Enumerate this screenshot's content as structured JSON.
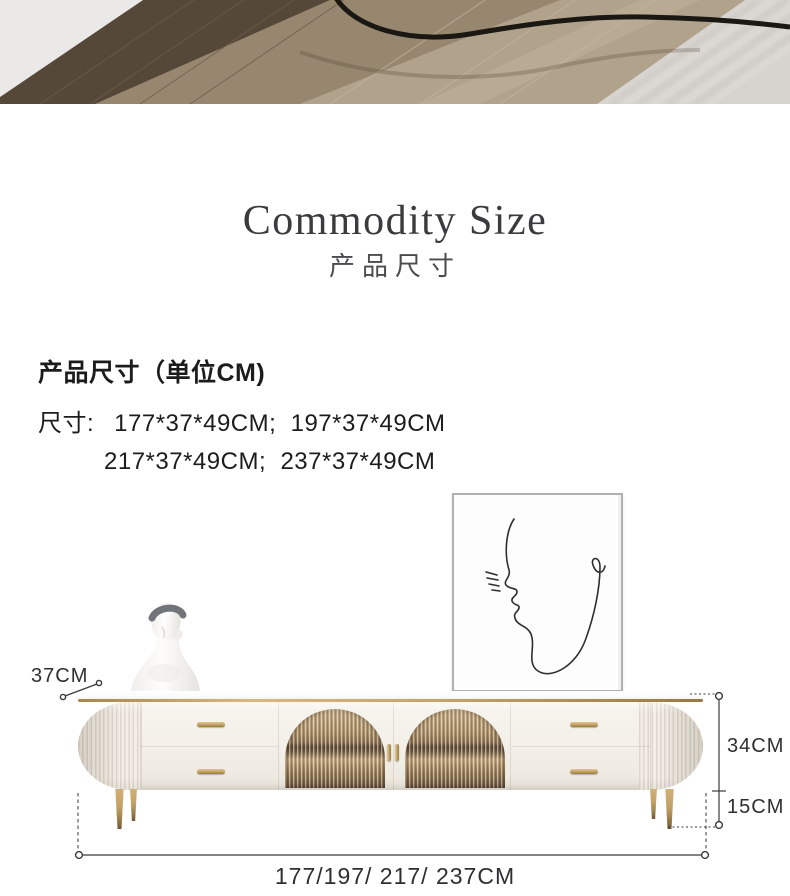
{
  "title": {
    "en": "Commodity Size",
    "zh": "产品尺寸"
  },
  "specs": {
    "heading": "产品尺寸（单位CM)",
    "size_label": "尺寸:",
    "line1_values": "177*37*49CM;  197*37*49CM",
    "line2_values": "217*37*49CM;  237*37*49CM"
  },
  "figure": {
    "depth_label": "37CM",
    "body_height_label": "34CM",
    "leg_height_label": "15CM",
    "width_label": "177/197/ 217/ 237CM"
  },
  "colors": {
    "title-text": "#3b3b3d",
    "body-text": "#1c1c1c",
    "dim-line": "#3a3a3a",
    "gold": "#c2a266",
    "gold-dark": "#9c7f4b",
    "cream": "#f3efe8",
    "cream-shade": "#ddd6c9",
    "glass-amber": "#a98c63",
    "glass-dark": "#54422f",
    "marble": "#fbfbfa",
    "frame-border": "#b0b0ae",
    "wood-dark": "#564839",
    "wood-mid": "#97876f",
    "wood-light": "#ab9d87",
    "carpet": "#d7d4cf"
  }
}
